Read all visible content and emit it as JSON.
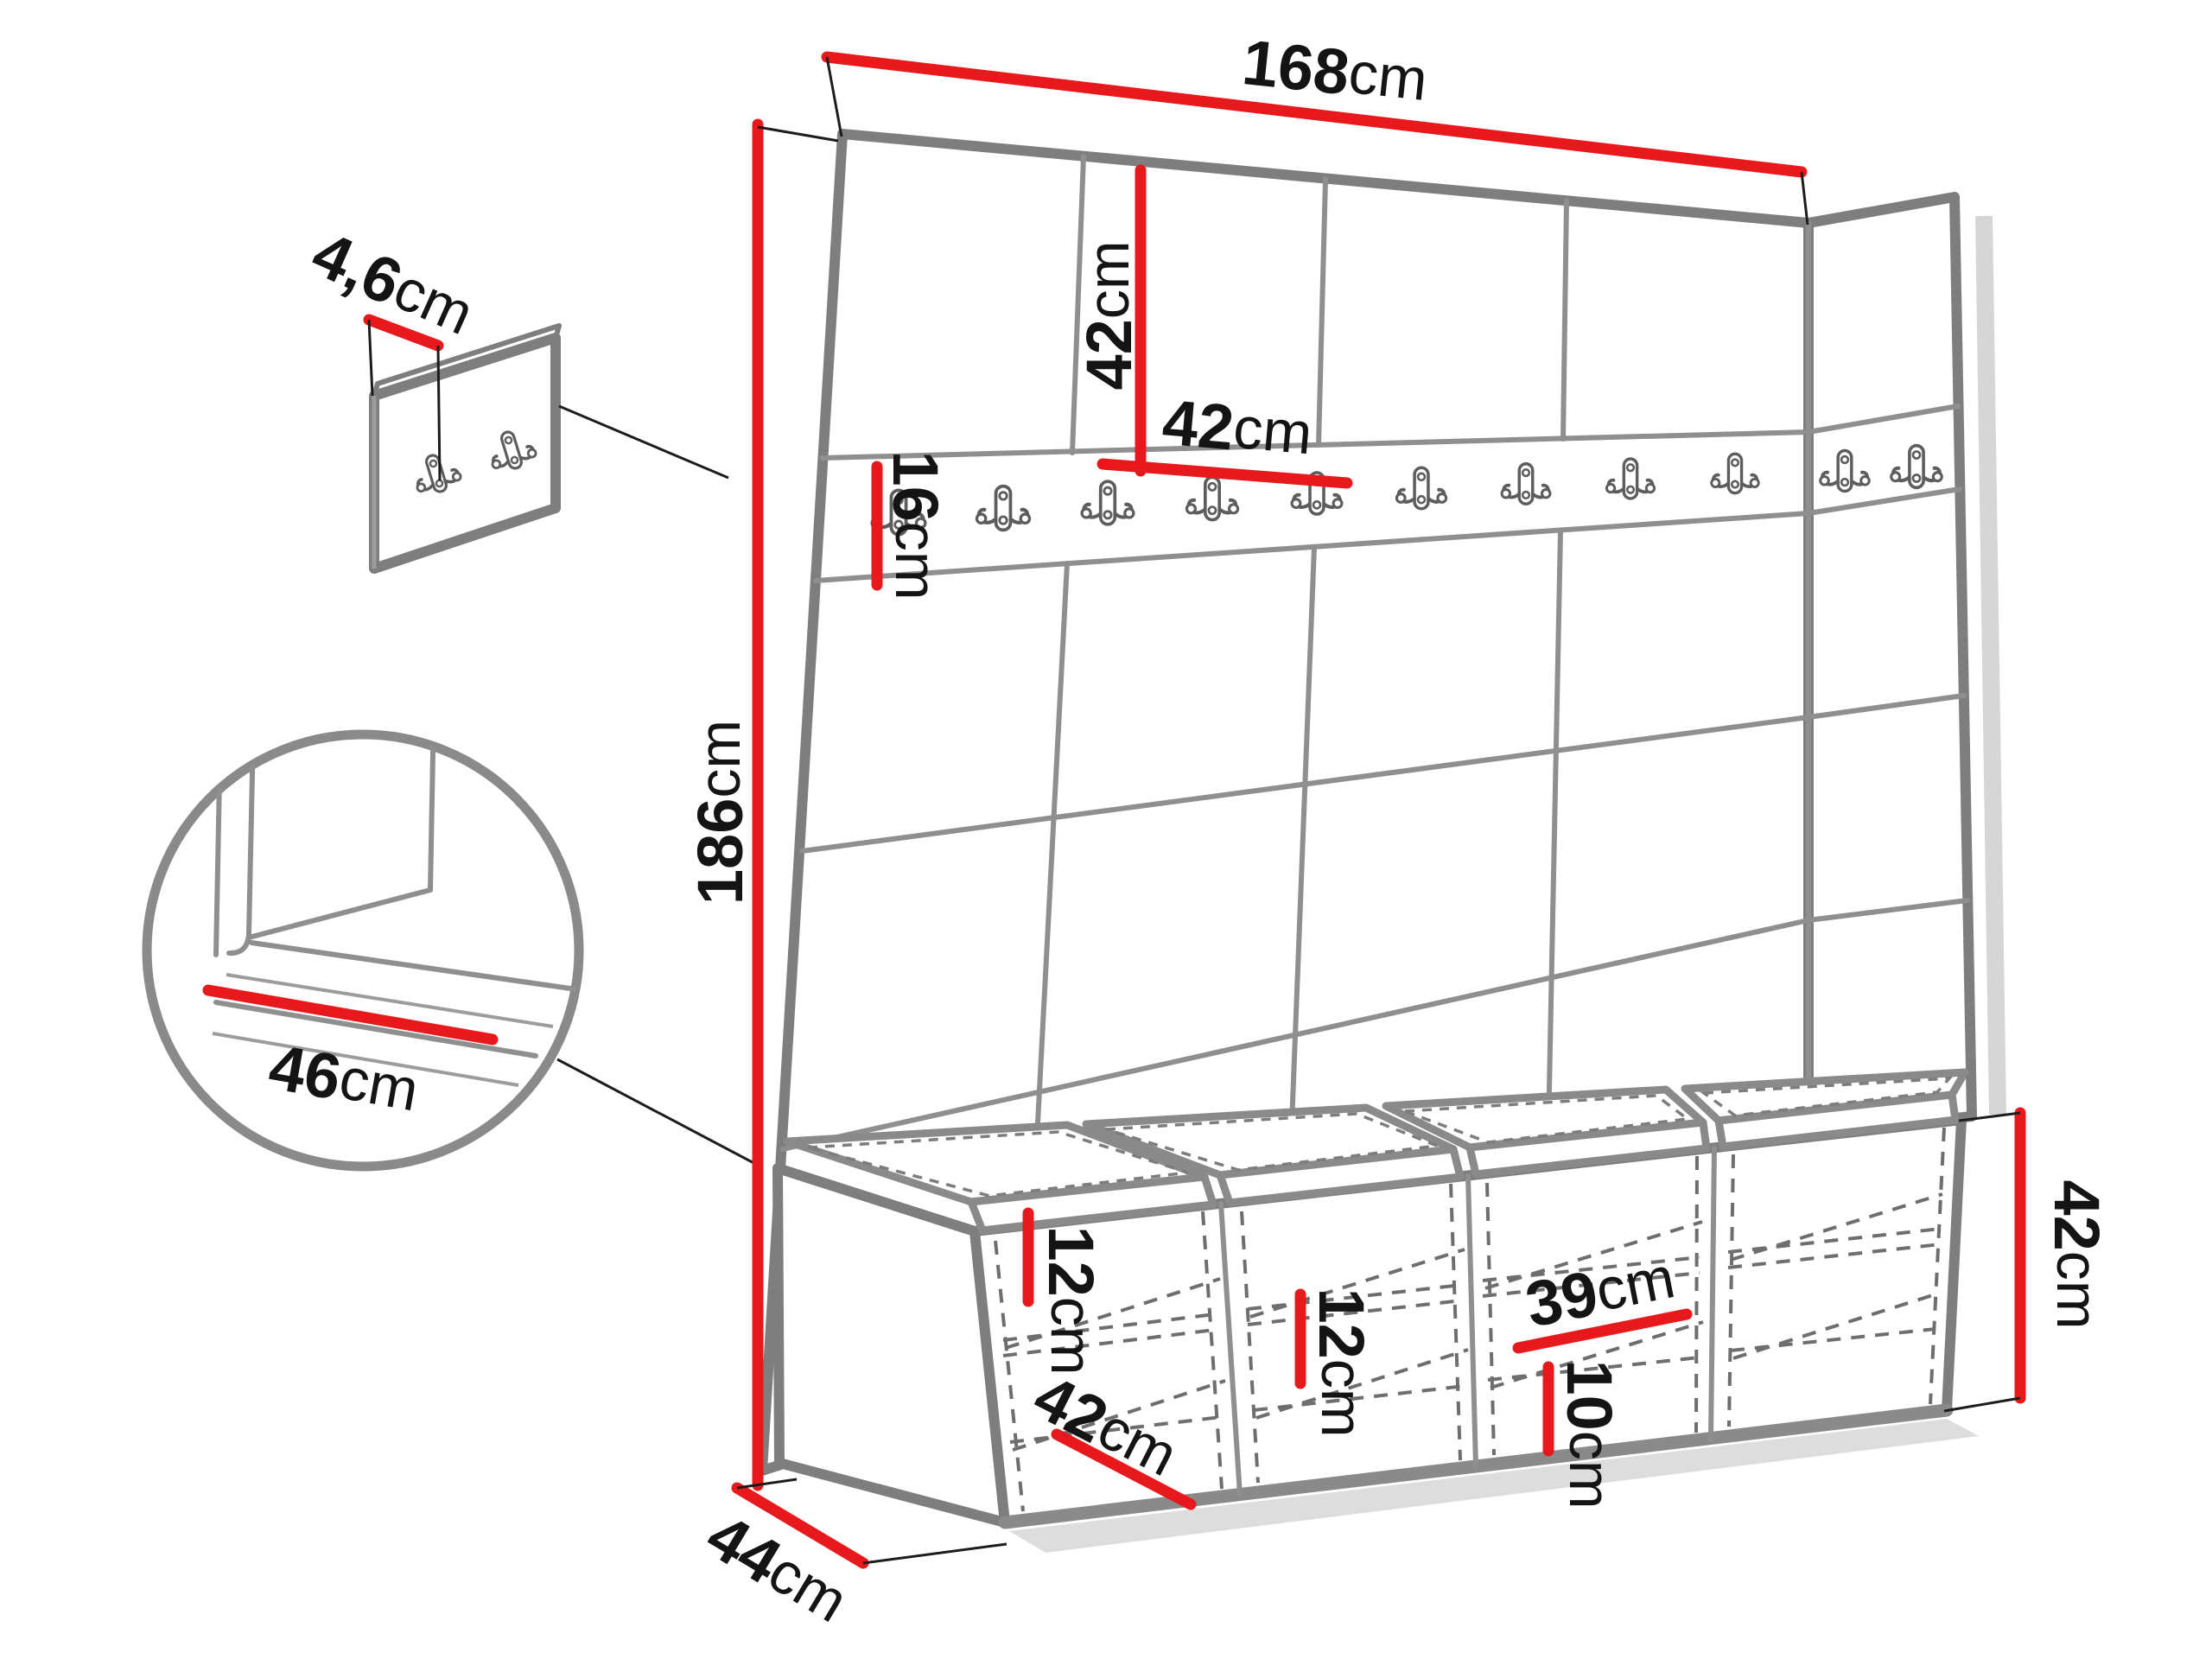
{
  "figure": {
    "type": "furniture-dimension-diagram",
    "subject": "hallway wardrobe wall panel set with coat-hook rail and shoe bench",
    "unit": "cm",
    "colors": {
      "dimension_line": "#e8191c",
      "outline_gray": "#7e7e7e",
      "label_text": "#141414",
      "background": "#ffffff"
    },
    "icons": {
      "coat_hook": "double-coat-hook-icon"
    },
    "labels": {
      "total_width": {
        "value": "168",
        "unit": "cm"
      },
      "top_panel_height": {
        "value": "42",
        "unit": "cm"
      },
      "panel_width": {
        "value": "42",
        "unit": "cm"
      },
      "rail_height": {
        "value": "16",
        "unit": "cm"
      },
      "total_height": {
        "value": "186",
        "unit": "cm"
      },
      "panel_thickness": {
        "value": "4,6",
        "unit": "cm"
      },
      "seat_depth": {
        "value": "46",
        "unit": "cm"
      },
      "cabinet1_shelf_gap": {
        "value": "12",
        "unit": "cm"
      },
      "cabinet1_width": {
        "value": "42",
        "unit": "cm"
      },
      "cabinet2_shelf_gap": {
        "value": "12",
        "unit": "cm"
      },
      "cabinet3_shelf_width": {
        "value": "39",
        "unit": "cm"
      },
      "cabinet3_bottom_gap": {
        "value": "10",
        "unit": "cm"
      },
      "bench_height": {
        "value": "42",
        "unit": "cm"
      },
      "bench_depth": {
        "value": "44",
        "unit": "cm"
      }
    }
  }
}
